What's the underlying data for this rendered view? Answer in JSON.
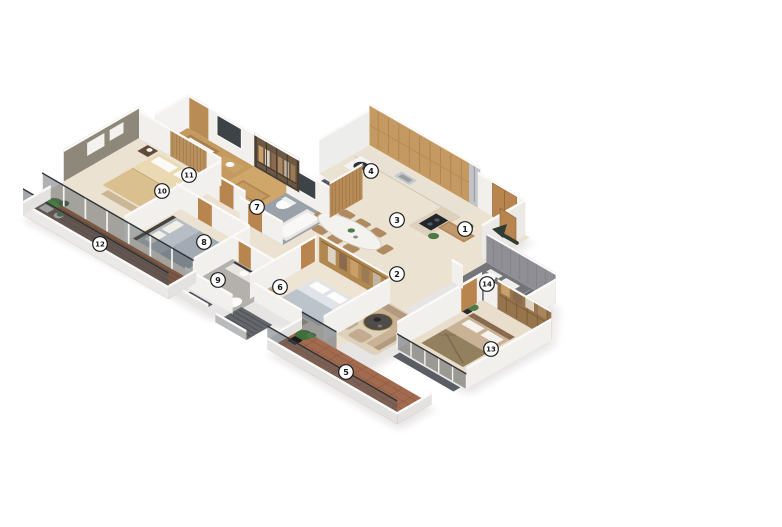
{
  "scene": {
    "kind": "3d-isometric-floor-plan-render",
    "background": "#ffffff"
  },
  "markers": [
    {
      "label": "1",
      "x": 465,
      "y": 229
    },
    {
      "label": "2",
      "x": 397,
      "y": 274
    },
    {
      "label": "3",
      "x": 397,
      "y": 220
    },
    {
      "label": "4",
      "x": 371,
      "y": 171
    },
    {
      "label": "5",
      "x": 346,
      "y": 372
    },
    {
      "label": "6",
      "x": 280,
      "y": 287
    },
    {
      "label": "7",
      "x": 257,
      "y": 207
    },
    {
      "label": "8",
      "x": 204,
      "y": 242
    },
    {
      "label": "9",
      "x": 218,
      "y": 280
    },
    {
      "label": "10",
      "x": 162,
      "y": 191
    },
    {
      "label": "11",
      "x": 189,
      "y": 175
    },
    {
      "label": "12",
      "x": 100,
      "y": 244
    },
    {
      "label": "13",
      "x": 491,
      "y": 349
    },
    {
      "label": "14",
      "x": 487,
      "y": 284
    }
  ],
  "entry_arrow": {
    "x": 505,
    "y": 234,
    "direction": "up-left",
    "color": "#2f3c35"
  },
  "palette": {
    "floor_cream": "#ece2d2",
    "floor_warm": "#e9decb",
    "wood_floor": "#c49a5e",
    "wardrobe_floor": "#cfa76a",
    "tile_bath7": "#9aa1ab",
    "tile_bath9": "#b4b1ac",
    "tile_bath14": "#74747b",
    "deck_wood": "#7a5845",
    "terrace_tile": "#a26a4e",
    "wall_white": "#f2f0ed",
    "accent_olive": "#8e887b",
    "cabinet_wood": "#c49a62",
    "door_wood": "#b9854f",
    "glass": "#4b545c",
    "marker_fill": "#ffffff",
    "marker_border": "#1d1d1f"
  }
}
